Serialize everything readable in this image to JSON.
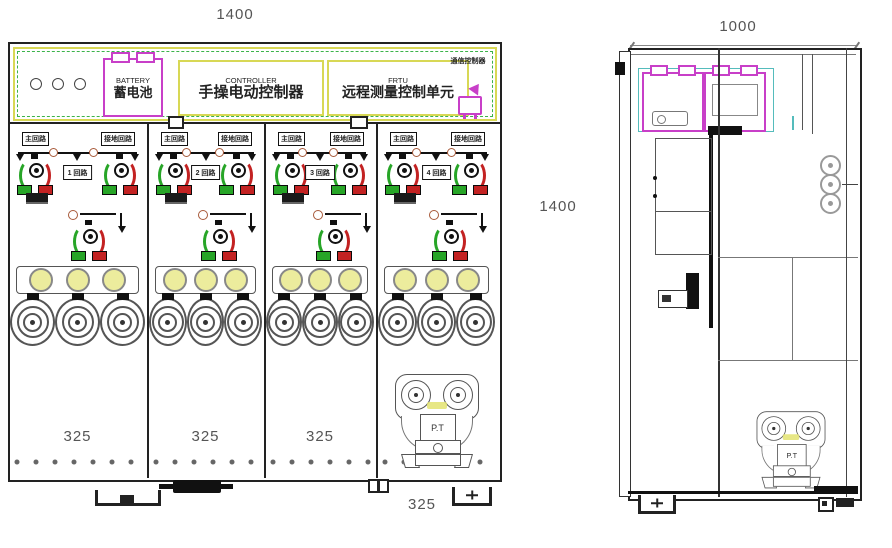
{
  "front_view": {
    "width_dim": "1400",
    "height_dim": "1400",
    "lv": {
      "battery_en": "BATTERY",
      "battery_zh": "蓄电池",
      "controller_en": "CONTROLLER",
      "controller_zh": "手操电动控制器",
      "frtu_en": "FRTU",
      "frtu_zh": "远程测量控制单元",
      "comm_zh": "通信控制器"
    },
    "panels": [
      {
        "main_label": "主回路",
        "earth_label": "接地回路",
        "circuit_label": "1 回路",
        "width_dim": "325"
      },
      {
        "main_label": "主回路",
        "earth_label": "接地回路",
        "circuit_label": "2 回路",
        "width_dim": "325"
      },
      {
        "main_label": "主回路",
        "earth_label": "接地回路",
        "circuit_label": "3 回路",
        "width_dim": "325"
      },
      {
        "main_label": "主回路",
        "earth_label": "接地回路",
        "circuit_label": "4 回路",
        "width_dim": "325"
      }
    ],
    "pt_label": "P.T"
  },
  "side_view": {
    "width_dim": "1000",
    "pt_label": "P.T"
  },
  "colors": {
    "line": "#222222",
    "yellow_border": "#d8d855",
    "green_dashed": "#3cb34a",
    "magenta": "#c83fc8",
    "cyan": "#55bcbc",
    "lamp_fill": "#ecec9d",
    "green": "#27a527",
    "red": "#c32222"
  }
}
